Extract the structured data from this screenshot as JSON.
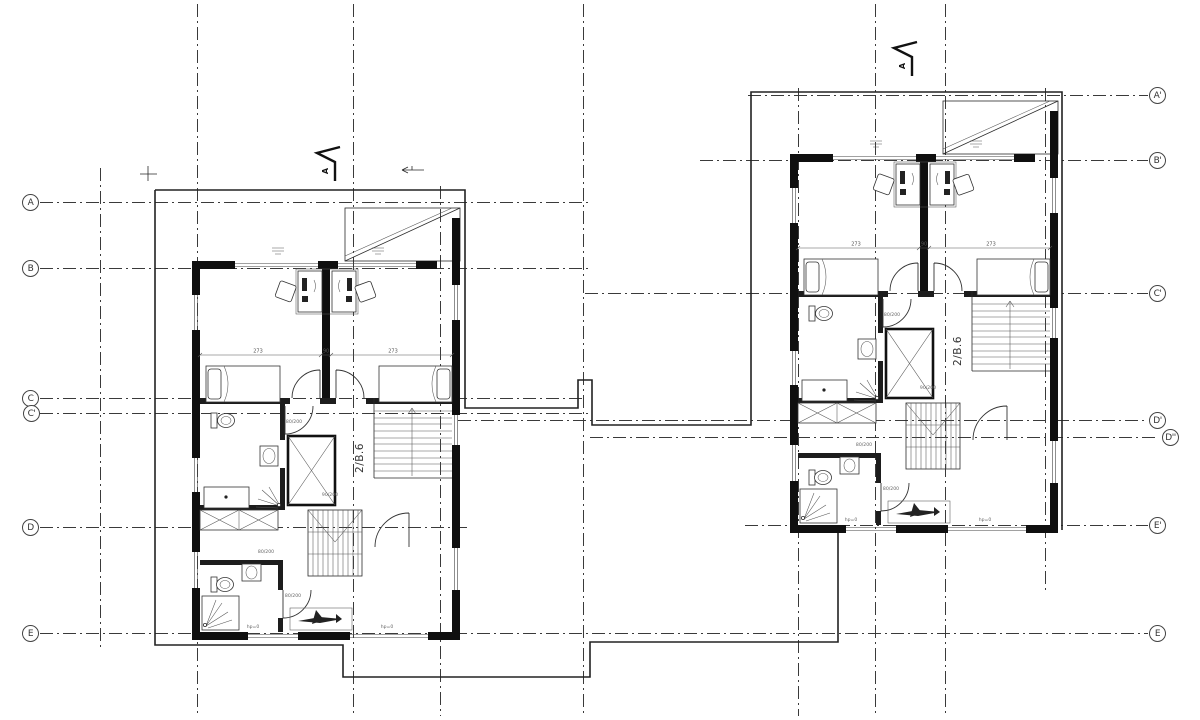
{
  "grid": {
    "left_bubbles": [
      {
        "label": "A"
      },
      {
        "label": "B"
      },
      {
        "label": "C"
      },
      {
        "label": "C'"
      },
      {
        "label": "D"
      },
      {
        "label": "E"
      }
    ],
    "right_bubbles": [
      {
        "label": "A'"
      },
      {
        "label": "B'"
      },
      {
        "label": "C'"
      },
      {
        "label": "D'"
      },
      {
        "label": "D''"
      },
      {
        "label": "E'"
      },
      {
        "label": "E"
      }
    ]
  },
  "drawing": {
    "unit_label": "2/B.6",
    "section_label": "A",
    "dim_left": "273",
    "dim_mid": "90",
    "dim_right": "273",
    "door_tag_1": "80/200",
    "door_tag_2": "90/200",
    "door_tag_3": "80/200",
    "door_tag_4": "80/200",
    "level_tag": "hp=0"
  }
}
